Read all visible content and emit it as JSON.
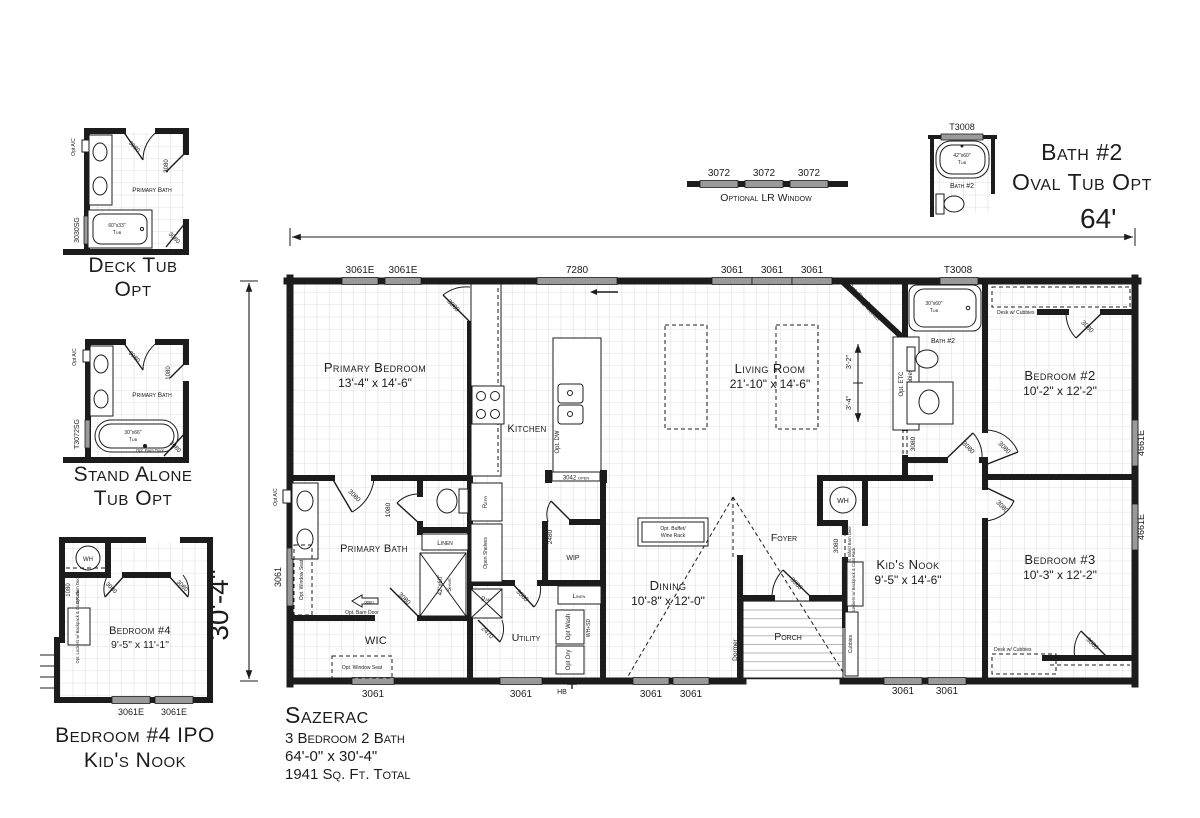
{
  "title_block": {
    "name": "Sazerac",
    "spec": "3 Bedroom 2 Bath",
    "size": "64'-0\" x 30'-4\"",
    "area": "1941 Sq. Ft. Total"
  },
  "dims": {
    "width": "64'",
    "height": "30'-4\"",
    "fp1": "3'-2\"",
    "fp2": "3'-4\""
  },
  "windows": {
    "top": [
      "3061E",
      "3061E",
      "7280",
      "3061",
      "3061",
      "3061",
      "T3008"
    ],
    "bottom": [
      "3061",
      "3061",
      "3061",
      "3061",
      "3061",
      "3061"
    ],
    "left": "3061",
    "right": [
      "4661E",
      "4661E"
    ],
    "hb": "HB"
  },
  "doors": {
    "pb_entry": "3080",
    "pb_bath": "3080",
    "toilet": "1080",
    "wic_barn": "3080",
    "pantry": "2470",
    "utility": "3080",
    "wip": "2480",
    "entry": "3080",
    "bath2": "3080",
    "hall_opening": "3080",
    "bed2": "3080",
    "bed2_top": "3080",
    "bed3": "3080",
    "bed3_bottom": "3080",
    "nook": "3080",
    "nook_bifold": "Opt. Bifold Barn Door"
  },
  "rooms": {
    "primary_bedroom": {
      "name": "Primary Bedroom",
      "size": "13'-4\" x 14'-6\""
    },
    "living": {
      "name": "Living Room",
      "size": "21'-10\" x 14'-6\""
    },
    "bedroom2": {
      "name": "Bedroom #2",
      "size": "10'-2\" x 12'-2\""
    },
    "bedroom3": {
      "name": "Bedroom #3",
      "size": "10'-3\" x 12'-2\""
    },
    "kids_nook": {
      "name": "Kid's Nook",
      "size": "9'-5\" x 14'-6\""
    },
    "dining": {
      "name": "Dining",
      "size": "10'-8\" x 12'-0\""
    },
    "primary_bath": "Primary Bath",
    "kitchen": "Kitchen",
    "wic": "WIC",
    "utility": "Utility",
    "foyer": "Foyer",
    "porch": "Porch",
    "bath2": "Bath #2",
    "wip": "WIP",
    "linen1": "Linen",
    "linen2": "Linen",
    "pan": "Pan"
  },
  "fixtures": {
    "refr": "Refr",
    "shelves": "Open Shelves",
    "dw": "Opt. DW",
    "open3042": "3042 open",
    "wash": "Opt Wash",
    "dry": "Opt Dry",
    "whsd": "WH+SD",
    "wh": "WH",
    "shower_size": "42\"x60\"",
    "shower_word": "Shwr",
    "tub2_size": "30\"x60\"",
    "tub2_word": "Tub",
    "buffet1": "Opt. Buffet/",
    "buffet2": "Wine Rack",
    "fireplace1": "Opt. Fireplace",
    "fireplace2": "w/ Mantel",
    "etc1": "Opt. ETC",
    "etc2": "w/ Cubbies",
    "cubbies": "Cubbies",
    "desk2": "Desk w/ Cubbies",
    "desk3": "Desk w/ Cubbies",
    "seat_left": "Opt. Window Seat",
    "seat_wic": "Opt. Window Seat",
    "barn": "Opt. Barn Door",
    "open_word": "open",
    "dormer": "Dormer",
    "ac": "Opt A/C",
    "lockers": "Opt. Lockers w/ Backpack & Coat Rack"
  },
  "inset_deck": {
    "caption1": "Deck Tub",
    "caption2": "Opt",
    "room": "Primary Bath",
    "tub_size": "60\"x33\"",
    "tub_word": "Tub",
    "window": "3030SG",
    "door_top": "3080",
    "door_right": "3080",
    "door_bottom": "3080",
    "ac": "Opt A/C"
  },
  "inset_stand": {
    "caption1": "Stand Alone",
    "caption2": "Tub Opt",
    "room": "Primary Bath",
    "tub_size": "30\"x66\"",
    "tub_word": "Tub",
    "window": "T3072SG",
    "door_top": "3080",
    "door_right": "1080",
    "door_bottom": "3080",
    "barn": "Opt. Barn Door",
    "ac": "Opt A/C"
  },
  "inset_bed4": {
    "caption1": "Bedroom #4 IPO",
    "caption2": "Kid's Nook",
    "name": "Bedroom #4",
    "size": "9'-5\" x 11'-1\"",
    "wh": "WH",
    "door_closet": "1080",
    "barn": "Opt. Barn Door",
    "lockers": "Opt. Lockers w/ Backpack & Coat Rack",
    "door_left": "3080",
    "door_right": "3080",
    "win1": "3061E",
    "win2": "3061E"
  },
  "inset_lrwin": {
    "caption": "Optional LR Window",
    "w1": "3072",
    "w2": "3072",
    "w3": "3072"
  },
  "inset_bath2": {
    "caption1": "Bath #2",
    "caption2": "Oval Tub Opt",
    "window": "T3008",
    "tub_size": "42\"x60\"",
    "tub_word": "Tub",
    "room": "Bath #2"
  }
}
